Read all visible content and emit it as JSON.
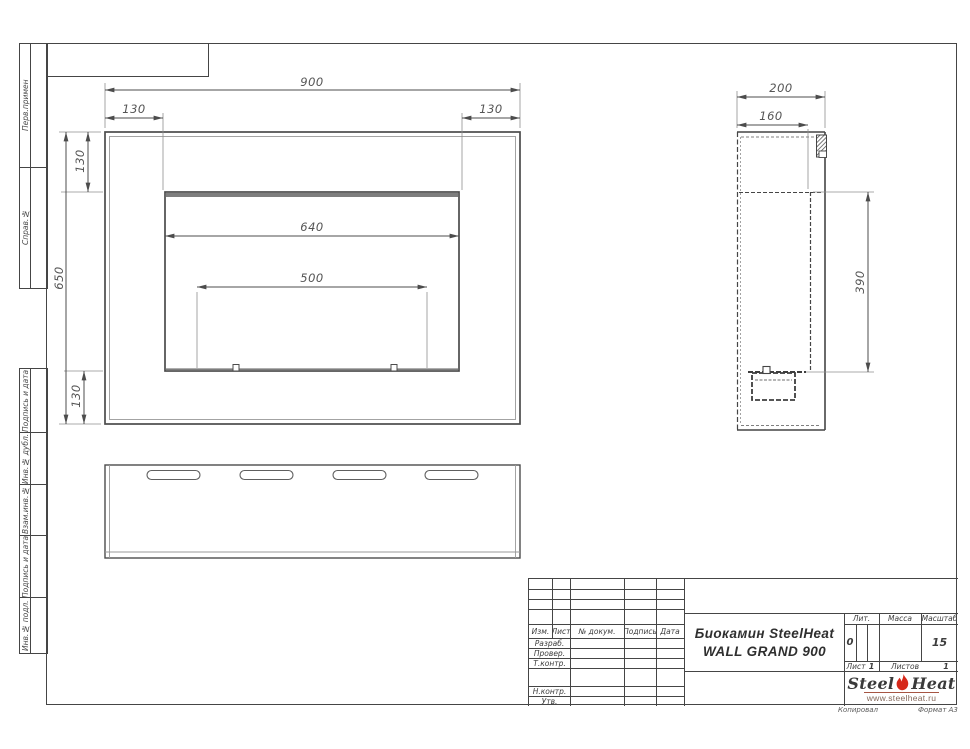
{
  "drawing_title": {
    "line1": "Биокамин SteelHeat",
    "line2": "WALL GRAND 900"
  },
  "dimensions": {
    "front": {
      "width": "900",
      "left_offset": "130",
      "right_offset": "130",
      "height": "650",
      "top_offset": "130",
      "bottom_offset": "130",
      "opening_width": "640",
      "burner_width": "500"
    },
    "side": {
      "depth": "200",
      "inner_depth": "160",
      "opening_height": "390"
    }
  },
  "left_margin": {
    "top_cells": [
      "Перв.примен",
      "Справ.№"
    ],
    "bottom_cells": [
      "Подпись и дата",
      "Инв.№ дубл.",
      "Взам.инв.№",
      "Подпись и дата",
      "Инв.№ подл."
    ]
  },
  "title_block": {
    "header": {
      "izm": "Изм.",
      "list": "Лист",
      "doc": "№ докум.",
      "sign": "Подпись",
      "date": "Дата"
    },
    "rows": {
      "developed": "Разраб.",
      "checked": "Провер.",
      "tcontrol": "Т.контр.",
      "ncontrol": "Н.контр.",
      "approved": "Утв."
    },
    "lit_label": "Лит.",
    "lit_value": "0",
    "mass_label": "Масса",
    "scale_label": "Масштаб",
    "scale_value": "15",
    "sheet_label": "Лист",
    "sheet_value": "1",
    "sheets_label": "Листов",
    "sheets_value": "1"
  },
  "logo": {
    "word1": "Steel",
    "word2": "Heat",
    "site": "www.steelheat.ru"
  },
  "footer": {
    "copied": "Копировал",
    "format": "Формат А3"
  },
  "colors": {
    "line": "#4c4c4c",
    "thin": "#979797",
    "red": "#d6281a"
  }
}
